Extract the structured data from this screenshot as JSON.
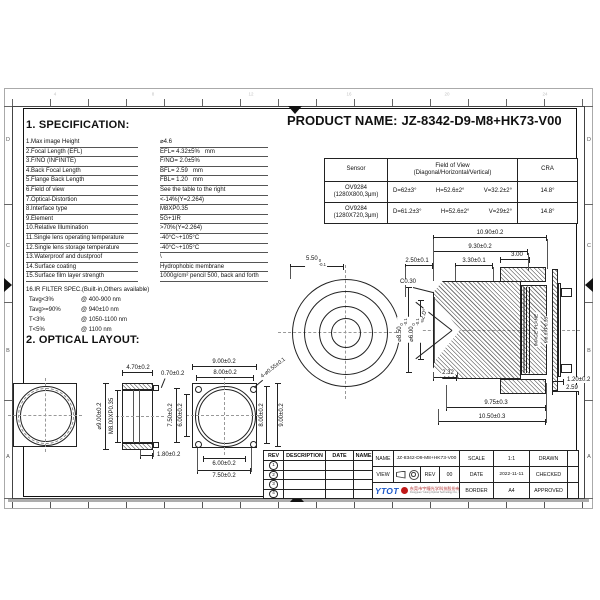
{
  "header": {
    "product_label": "PRODUCT NAME:",
    "product_name": "JZ-8342-D9-M8+HK73-V00"
  },
  "spec": {
    "title": "1. SPECIFICATION:",
    "rows": [
      {
        "label": "1.Max image Height",
        "value": "⌀4.6"
      },
      {
        "label": "2.Focal Length (EFL)",
        "value": "EFL= 4.32±5%   mm"
      },
      {
        "label": "3.F/NO (INFINITE)",
        "value": "F/NO= 2.0±5%"
      },
      {
        "label": "4.Back Focal Length",
        "value": "BFL= 2.59   mm"
      },
      {
        "label": "5.Flange Back Length",
        "value": "FBL= 1.20   mm"
      },
      {
        "label": "6.Field of view",
        "value": "See the table to the right"
      },
      {
        "label": "7.Optical-Distortion",
        "value": "<-14%(Y=2.264)"
      },
      {
        "label": "8.Interface type",
        "value": "M8XP0.35"
      },
      {
        "label": "9.Element",
        "value": "5G+1IR"
      },
      {
        "label": "10.Relative Illumination",
        "value": ">70%(Y=2.264)"
      },
      {
        "label": "11.Single lens operating temperature",
        "value": "-40°C~+105°C"
      },
      {
        "label": "12.Single lens storage temperature",
        "value": "-40°C~+105°C"
      },
      {
        "label": "13.Waterproof and dustproof",
        "value": "\\"
      },
      {
        "label": "14.Surface coating",
        "value": "Hydrophobic membrane"
      },
      {
        "label": "15.Surface film layer strength",
        "value": "1000g/cm² pencil 500, back and forth"
      }
    ],
    "ir_heading": "16.IR FILTER SPEC.(Built-in,Others available)",
    "ir_rows": [
      {
        "cond": "Tavg<3%",
        "range": "@ 400-900 nm"
      },
      {
        "cond": "Tavg>=90%",
        "range": "@ 940±10 nm"
      },
      {
        "cond": "T<3%",
        "range": "@ 1050-1100 nm"
      },
      {
        "cond": "T<5%",
        "range": "@ 1100 nm"
      }
    ]
  },
  "optical": {
    "title": "2. OPTICAL LAYOUT:"
  },
  "sensor_table": {
    "headers": {
      "sensor": "Sensor",
      "fov1": "Field of View",
      "fov2": "(Diagonal/Horizontal/Vertical)",
      "cra": "CRA"
    },
    "rows": [
      {
        "sensor1": "OV9284",
        "sensor2": "(1280X800,3μm)",
        "d": "D=62±3°",
        "h": "H=52.6±2°",
        "v": "V=32.2±2°",
        "cra": "14.8°"
      },
      {
        "sensor1": "OV9284",
        "sensor2": "(1280X720,3μm)",
        "d": "D=61.2±3°",
        "h": "H=52.6±2°",
        "v": "V=29±2°",
        "cra": "14.8°"
      }
    ]
  },
  "front_view": {
    "d550": "5.50",
    "d550_top": "0",
    "d550_bot": "-0.1"
  },
  "side_view": {
    "d1090": "10.90±0.2",
    "d930": "9.30±0.2",
    "d250": "2.50±0.1",
    "d330": "3.30±0.1",
    "d300": "3.00",
    "c030": "C0.30",
    "angle": "62.0°",
    "d850": "⌀8.50",
    "d850_top": "0",
    "d850_bot": "-0.1",
    "d600": "⌀6.00",
    "d600_top": "0",
    "d600_bot": "-0.1",
    "image_plane": "IMAGE PLANE",
    "thread": "M8.0XP0.35",
    "d232": "2.32",
    "d120": "1.20±0.2",
    "d259": "2.59",
    "d975": "9.75±0.3",
    "d1050": "10.50±0.3"
  },
  "layout": {
    "side": {
      "d470": "4.70±0.2",
      "d070": "0.70±0.2",
      "d900": "⌀9.00±0.2",
      "thread": "M8.00XP0.35",
      "d180": "1.80±0.2"
    },
    "front": {
      "top1": "9.00±0.2",
      "top2": "8.00±0.2",
      "left1": "7.50±0.2",
      "left2": "6.00±0.2",
      "right1": "8.00±0.2",
      "right2": "9.00±0.2",
      "bot1": "6.00±0.2",
      "bot2": "7.50±0.2",
      "holes": "4-⌀0.55±0.1"
    }
  },
  "rev_table": {
    "headers": [
      "REV",
      "DESCRIPTION",
      "DATE",
      "NAME"
    ],
    "rows": [
      "1",
      "2",
      "3",
      "4"
    ]
  },
  "title_block": {
    "name_label": "NAME",
    "name_value": "JZ-8342-D9-M8+HK73-V00",
    "view_label": "VIEW",
    "rev_label": "REV",
    "rev_value": "00",
    "scale_label": "SCALE",
    "scale_value": "1:1",
    "date_label": "DATE",
    "date_value": "2022-11-11",
    "border_label": "BORDER",
    "border_value": "A4",
    "drawn_label": "DRAWN",
    "checked_label": "CHECKED",
    "approved_label": "APPROVED",
    "brand": "YTOT",
    "company_cn": "东莞市宇瞳光学科技股份有限公司",
    "company_en": "Dongguan Yutong Optical Technology Co., Ltd."
  },
  "frame": {
    "zone_letters": [
      "D",
      "C",
      "B",
      "A"
    ],
    "zone_numbers": [
      "4",
      "8",
      "12",
      "16",
      "20",
      "24"
    ]
  }
}
